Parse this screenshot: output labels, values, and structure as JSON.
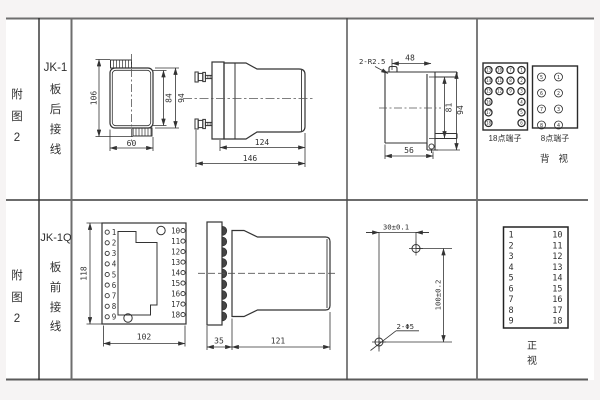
{
  "row1": {
    "fig_no": "附图2",
    "model": "JK-1",
    "wiring": "板后接线",
    "front": {
      "d106": "106",
      "d84": "84",
      "d94": "94",
      "d60": "60"
    },
    "side": {
      "d124": "124",
      "d146": "146"
    },
    "cutout": {
      "r": "2-R2.5",
      "d48": "48",
      "d81": "81",
      "d94": "94",
      "d56": "56"
    },
    "rear": {
      "t18_label": "18点端子",
      "t8_label": "8点端子",
      "view": "背视",
      "t18": {
        "outer_left": [
          "13",
          "14",
          "15",
          "16",
          "17",
          "18"
        ],
        "inner_left": [
          "10",
          "11",
          "12"
        ],
        "inner_right": [
          "7",
          "8",
          "9"
        ],
        "outer_right": [
          "1",
          "2",
          "3",
          "4",
          "5",
          "6"
        ]
      },
      "t8": {
        "left": [
          "5",
          "6",
          "7",
          "8"
        ],
        "right": [
          "1",
          "2",
          "3",
          "4"
        ]
      }
    }
  },
  "row2": {
    "fig_no": "附图2",
    "model": "JK-1Q",
    "wiring": "板前接线",
    "front": {
      "d118": "118",
      "d102": "102",
      "left": [
        "1",
        "2",
        "3",
        "4",
        "5",
        "6",
        "7",
        "8",
        "9"
      ],
      "right": [
        "10",
        "11",
        "12",
        "13",
        "14",
        "15",
        "16",
        "17",
        "18"
      ]
    },
    "side": {
      "d35": "35",
      "d121": "121"
    },
    "drill": {
      "d30": "30±0.1",
      "d100": "100±0.2",
      "holes": "2-Φ5"
    },
    "panel": {
      "view": "正视",
      "left": [
        "1",
        "2",
        "3",
        "4",
        "5",
        "6",
        "7",
        "8",
        "9"
      ],
      "right": [
        "10",
        "11",
        "12",
        "13",
        "14",
        "15",
        "16",
        "17",
        "18"
      ]
    }
  }
}
